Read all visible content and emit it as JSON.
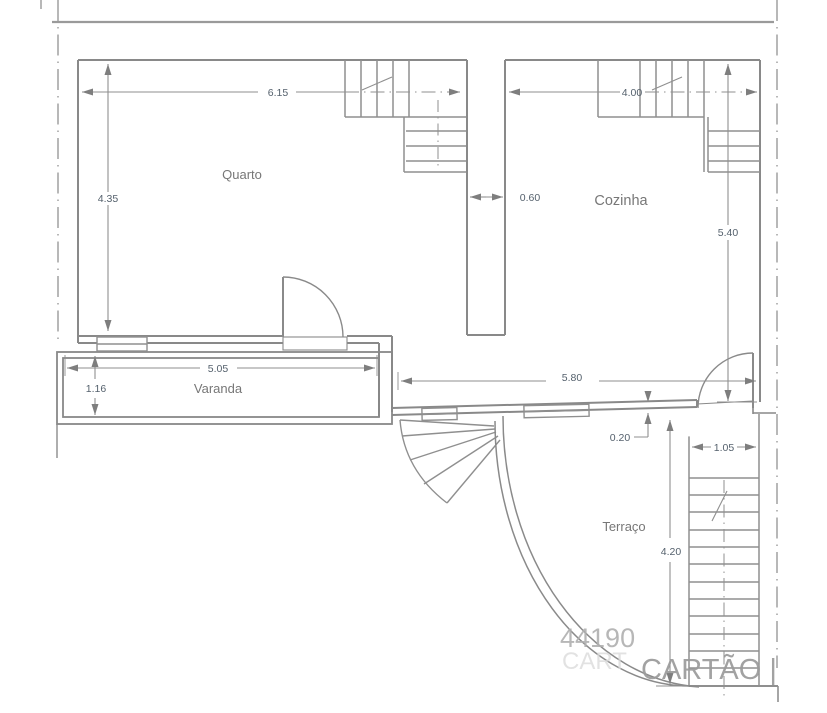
{
  "drawing_type": "floor-plan",
  "rooms": {
    "quarto": "Quarto",
    "cozinha": "Cozinha",
    "varanda": "Varanda",
    "terraco": "Terraço"
  },
  "dimensions": {
    "quarto_width": "6.15",
    "quarto_depth": "4.35",
    "cozinha_width": "4.00",
    "cozinha_depth": "5.40",
    "duct_width": "0.60",
    "varanda_width": "5.05",
    "varanda_depth": "1.16",
    "terraco_wall": "5.80",
    "wall_thickness": "0.20",
    "terraco_depth": "4.20",
    "stairs_width": "1.05"
  },
  "watermark": {
    "number": "44190",
    "ghost": "CART",
    "name": "CARTÃO |"
  },
  "colors": {
    "wall": "#898989",
    "stair": "#8f8f8f",
    "dimension": "#8f8f8f",
    "boundary": "#9a9a9a",
    "dim_text": "#55616d",
    "room_text": "#777777",
    "watermark": "#a8a8a8"
  }
}
